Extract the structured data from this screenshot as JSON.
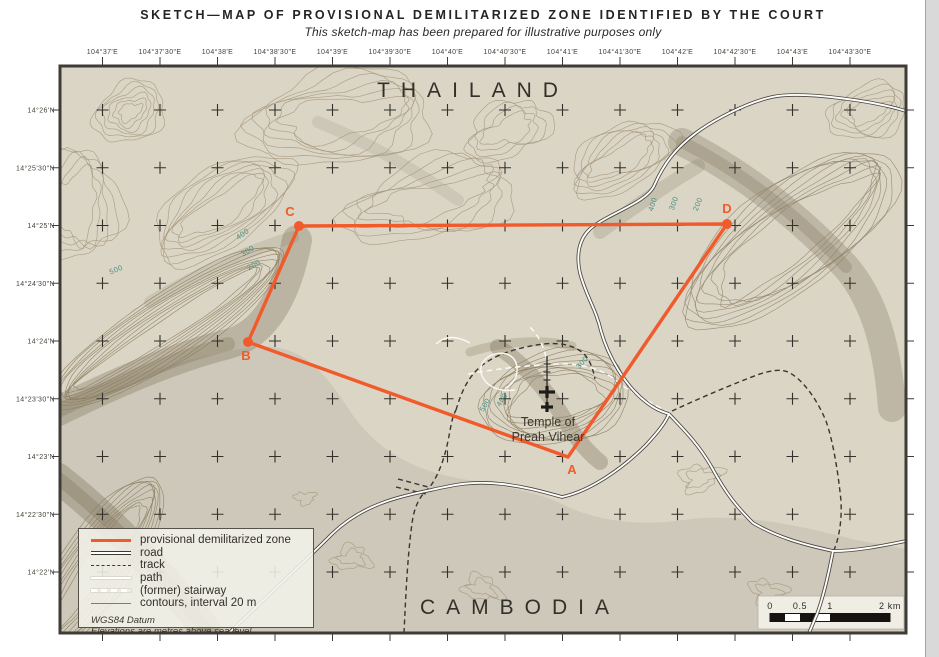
{
  "title": {
    "text": "SKETCH—MAP OF PROVISIONAL DEMILITARIZED ZONE IDENTIFIED BY THE COURT",
    "subtitle": "This sketch-map has been prepared for illustrative purposes only"
  },
  "map": {
    "country_top": "THAILAND",
    "country_bottom": "CAMBODIA",
    "temple": {
      "line1": "Temple of",
      "line2": "Preah Vihear"
    },
    "top_labels": [
      "104°37'E",
      "104°37'30\"E",
      "104°38'E",
      "104°38'30\"E",
      "104°39'E",
      "104°39'30\"E",
      "104°40'E",
      "104°40'30\"E",
      "104°41'E",
      "104°41'30\"E",
      "104°42'E",
      "104°42'30\"E",
      "104°43'E",
      "104°43'30\"E"
    ],
    "left_labels": [
      "14°26'N",
      "14°25'30\"N",
      "14°25'N",
      "14°24'30\"N",
      "14°24'N",
      "14°23'30\"N",
      "14°23'N",
      "14°22'30\"N",
      "14°22'N"
    ],
    "zone": {
      "name": "provisional demilitarized zone",
      "points": [
        {
          "id": "A",
          "x": 568,
          "y": 457,
          "dot": false,
          "lx": 572,
          "ly": 474
        },
        {
          "id": "B",
          "x": 248,
          "y": 342,
          "dot": true,
          "lx": 246,
          "ly": 360
        },
        {
          "id": "C",
          "x": 299,
          "y": 226,
          "dot": true,
          "lx": 290,
          "ly": 216
        },
        {
          "id": "D",
          "x": 727,
          "y": 224,
          "dot": true,
          "lx": 727,
          "ly": 213
        }
      ]
    },
    "contour_labels": [
      {
        "t": "500",
        "x": 117,
        "y": 272,
        "r": -22
      },
      {
        "t": "400",
        "x": 244,
        "y": 236,
        "r": -35
      },
      {
        "t": "300",
        "x": 249,
        "y": 253,
        "r": -33
      },
      {
        "t": "200",
        "x": 255,
        "y": 267,
        "r": -30
      },
      {
        "t": "500",
        "x": 487,
        "y": 406,
        "r": -60
      },
      {
        "t": "400",
        "x": 504,
        "y": 401,
        "r": -58
      },
      {
        "t": "300",
        "x": 584,
        "y": 364,
        "r": -48
      },
      {
        "t": "400",
        "x": 655,
        "y": 205,
        "r": -72
      },
      {
        "t": "300",
        "x": 676,
        "y": 204,
        "r": -70
      },
      {
        "t": "200",
        "x": 700,
        "y": 205,
        "r": -68
      }
    ]
  },
  "legend": {
    "items": [
      {
        "type": "zone",
        "label": "provisional demilitarized zone"
      },
      {
        "type": "road",
        "label": "road"
      },
      {
        "type": "track",
        "label": "track"
      },
      {
        "type": "path",
        "label": "path"
      },
      {
        "type": "stair",
        "label": "(former) stairway"
      },
      {
        "type": "cont",
        "label": "contours, interval 20 m"
      }
    ],
    "footnotes": [
      "WGS84 Datum",
      "Elevations are metres above sea level"
    ]
  },
  "scalebar": {
    "ticks": [
      "0",
      "0.5",
      "1",
      "2 km"
    ]
  }
}
